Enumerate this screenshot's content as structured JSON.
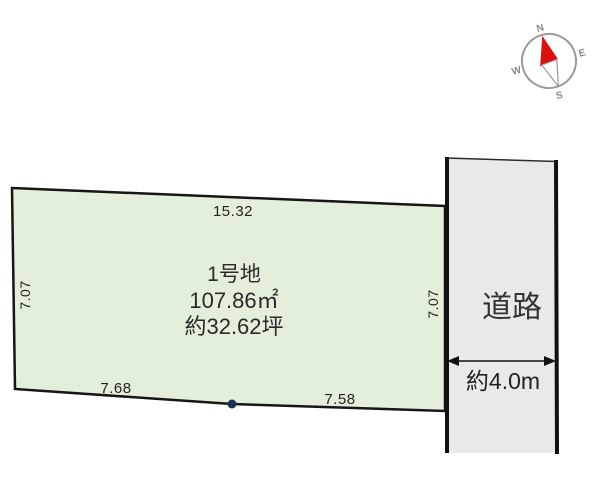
{
  "compass": {
    "north": "N",
    "east": "E",
    "south": "S",
    "west": "W"
  },
  "parcel": {
    "name": "1号地",
    "area_sqm": "107.86㎡",
    "area_tsubo": "約32.62坪",
    "dimensions": {
      "top": "15.32",
      "left": "7.07",
      "right": "7.07",
      "bottom_left": "7.68",
      "bottom_right": "7.58"
    }
  },
  "road": {
    "label": "道路",
    "width_label": "約4.0m"
  },
  "colors": {
    "parcel_fill": "#e4efdb",
    "road_fill": "#e9e9e9",
    "outline": "#1a1a1a",
    "needle_red": "#dd1010",
    "marker_dot": "#1c2f56"
  }
}
